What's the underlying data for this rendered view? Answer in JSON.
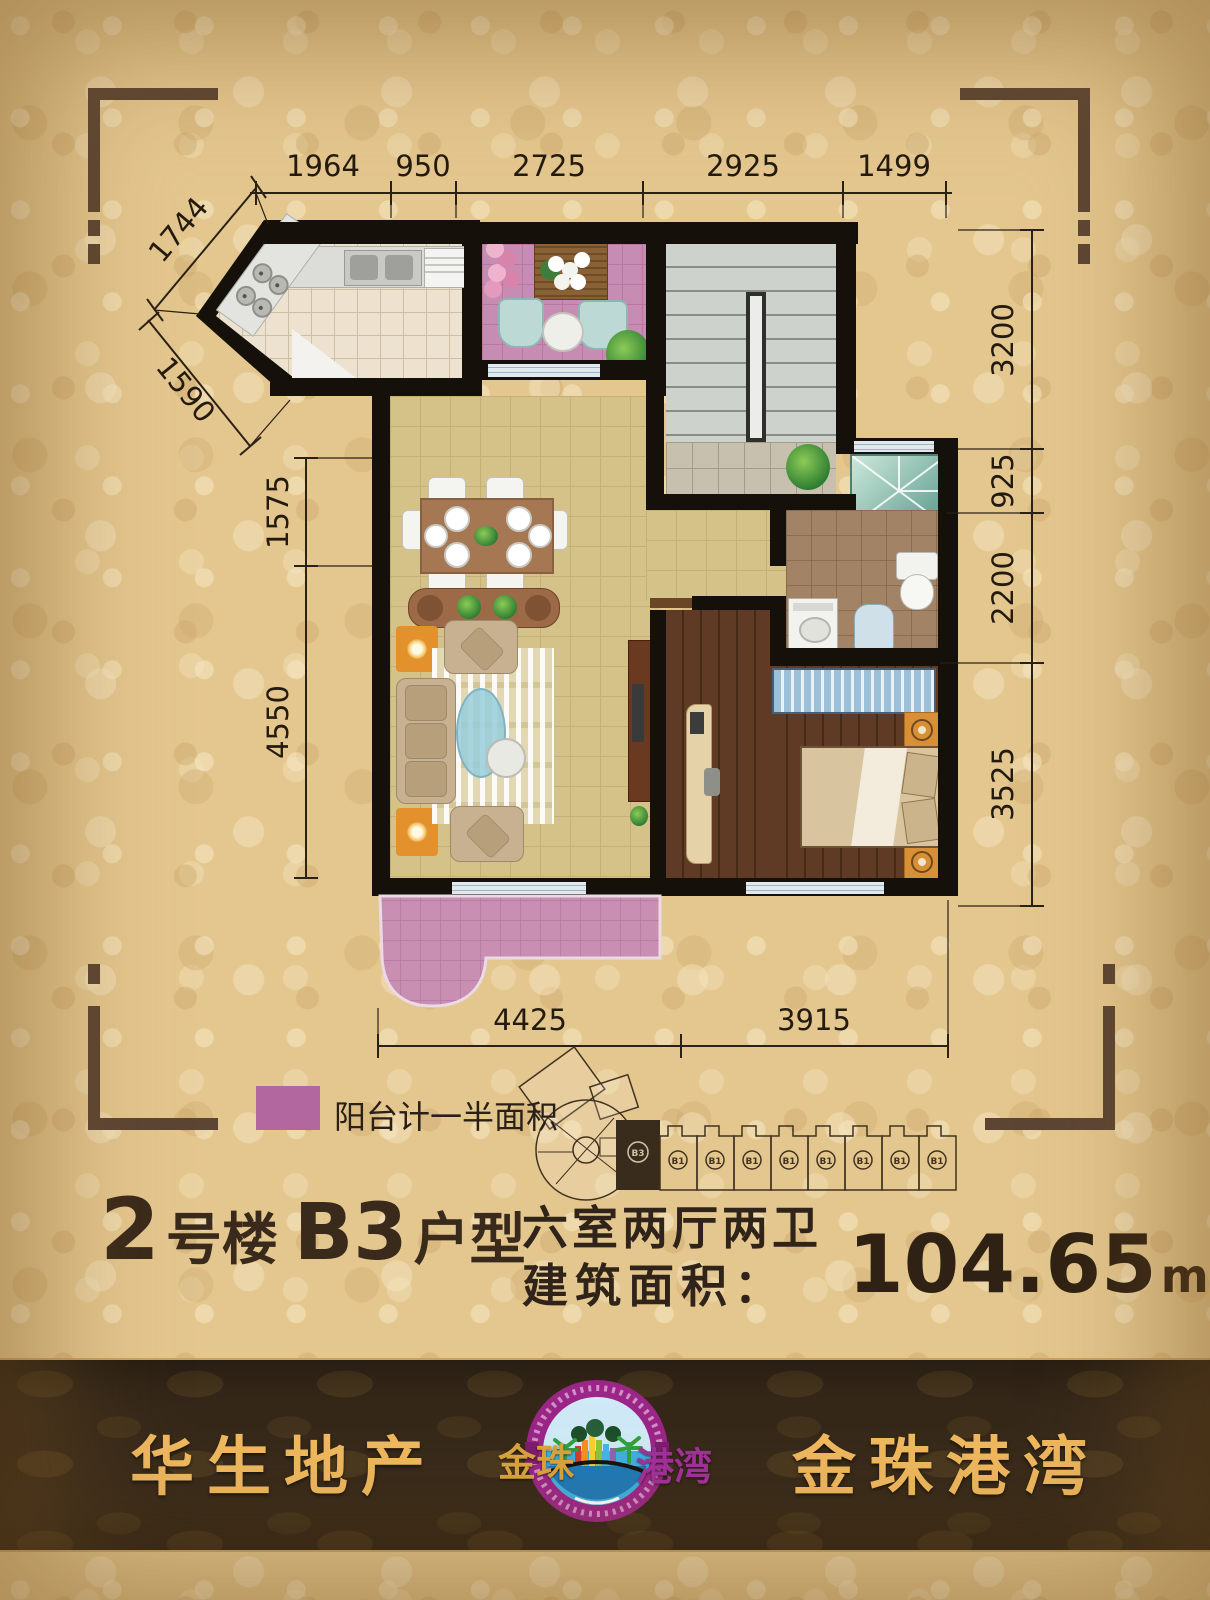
{
  "legend": {
    "label": "阳台计一半面积"
  },
  "dims": {
    "top": [
      "1964",
      "950",
      "2725",
      "2925",
      "1499"
    ],
    "diag_upper": "1744",
    "diag_lower": "1590",
    "left": [
      "1575",
      "4550"
    ],
    "right": [
      "3200",
      "925",
      "2200",
      "3525"
    ],
    "bottom": [
      "4425",
      "3915"
    ]
  },
  "keyplan": {
    "units": [
      "B3",
      "B1",
      "B1",
      "B1",
      "B1",
      "B1",
      "B1",
      "B1",
      "B1"
    ]
  },
  "title": {
    "building_no": "2",
    "building_label": "号楼",
    "unit": "B3",
    "unit_label": "户型"
  },
  "specs": {
    "rooms": "六室两厅两卫",
    "area_label": "建筑面积：",
    "area_value": "104.65",
    "area_unit": "m",
    "area_sup": "2"
  },
  "footer": {
    "brand_left": "华生地产",
    "brand_right": "金珠港湾",
    "logo_left": "金珠",
    "logo_right": "港湾"
  },
  "colors": {
    "balcony_pink": "#b3679f",
    "gold": "#f0b95f",
    "band": "#37291a",
    "wall": "#15100a"
  }
}
